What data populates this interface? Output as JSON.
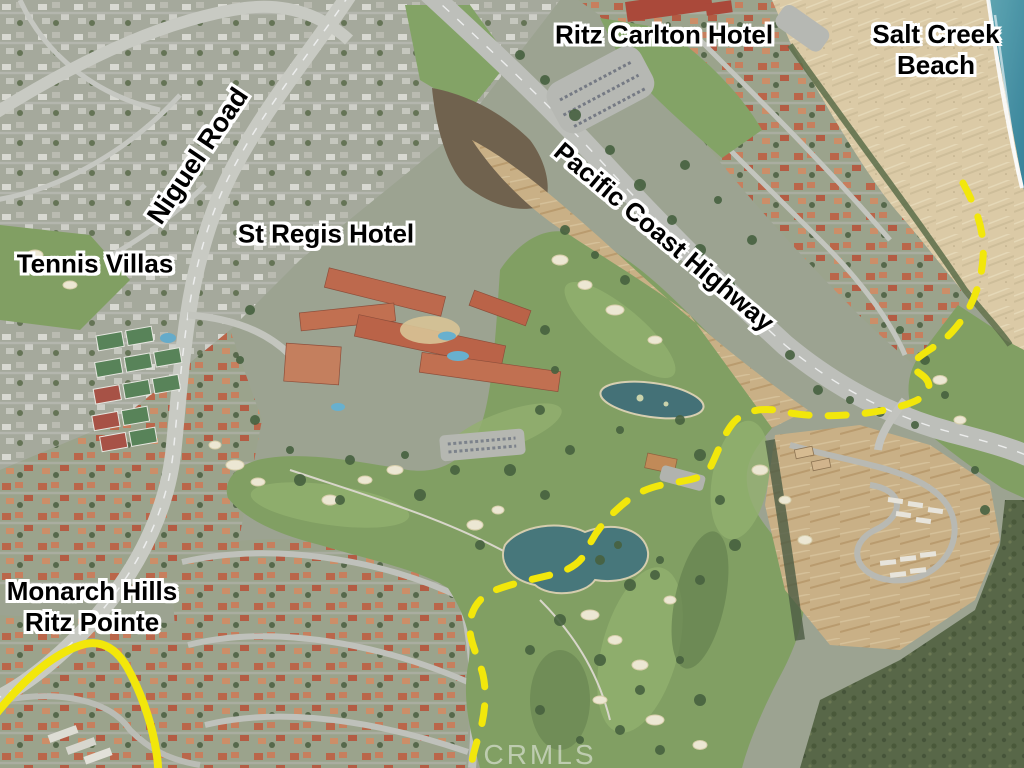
{
  "labels": {
    "ritz_carlton": "Ritz Carlton Hotel",
    "salt_creek_line1": "Salt Creek",
    "salt_creek_line2": "Beach",
    "niguel_road": "Niguel Road",
    "pacific_coast_highway": "Pacific Coast Highway",
    "st_regis": "St Regis Hotel",
    "tennis_villas": "Tennis Villas",
    "monarch_line1": "Monarch Hills",
    "monarch_line2": "Ritz Pointe"
  },
  "watermark": {
    "text": "CRMLS"
  },
  "annotations": {
    "dashed_route": "yellow dashed trail from Salt Creek Beach through golf course to Ritz Pointe",
    "solid_outline": "solid yellow outline around Monarch Hills condo cluster"
  },
  "colors": {
    "route_yellow": "#f2e70b",
    "label_text": "#000000",
    "label_halo": "#ffffff",
    "ocean": "#3d8ba1",
    "beach_sand": "#dcc9a2",
    "golf_green": "#7d9c5b",
    "dirt": "#c9ae80",
    "road": "#c8c9c1",
    "roof_red": "#b95f41"
  }
}
